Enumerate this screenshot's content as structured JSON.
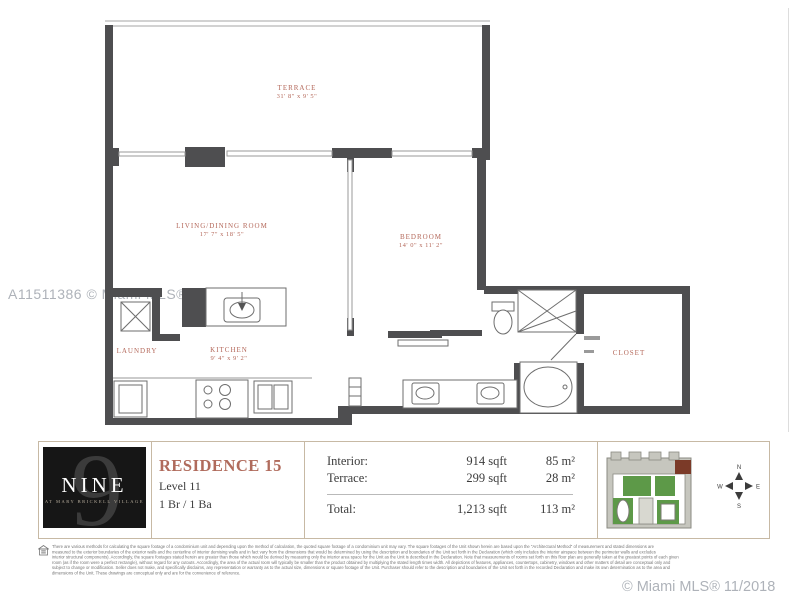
{
  "watermarks": {
    "left": "A11511386 © Miami MLS® 2023",
    "bottom_right": "© Miami MLS® 11/2018"
  },
  "colors": {
    "wall": "#4e4e50",
    "accent_terracotta": "#b06b5c",
    "info_border_tan": "#c7b9a4",
    "keyplan_green": "#5d9948",
    "keyplan_highlight": "#7b3a28"
  },
  "floorplan": {
    "rooms": {
      "terrace": {
        "name": "TERRACE",
        "dims": "31' 8\" x 9' 5\""
      },
      "living": {
        "name": "LIVING/DINING ROOM",
        "dims": "17' 7\" x 18' 5\""
      },
      "bedroom": {
        "name": "BEDROOM",
        "dims": "14' 0\" x 11' 2\""
      },
      "kitchen": {
        "name": "KITCHEN",
        "dims": "9' 4\" x 9' 2\""
      },
      "laundry": {
        "name": "LAUNDRY",
        "dims": ""
      },
      "closet": {
        "name": "CLOSET",
        "dims": ""
      }
    }
  },
  "info_bar": {
    "logo": {
      "number": "9",
      "name": "NINE",
      "tagline": "AT MARY BRICKELL VILLAGE"
    },
    "residence": {
      "title": "RESIDENCE 15",
      "level": "Level 11",
      "beds_baths": "1 Br / 1 Ba"
    },
    "areas": {
      "rows": [
        {
          "label": "Interior:",
          "sqft": "914 sqft",
          "metric": "85 m²"
        },
        {
          "label": "Terrace:",
          "sqft": "299 sqft",
          "metric": "28 m²"
        }
      ],
      "total": {
        "label": "Total:",
        "sqft": "1,213 sqft",
        "metric": "113 m²"
      }
    },
    "compass": {
      "n": "N",
      "e": "E",
      "s": "S",
      "w": "W"
    }
  },
  "disclaimer": {
    "lines": [
      "There are various methods for calculating the square footage of a condominium unit and depending upon the method of calculation, the quoted square footage of a condominium unit may vary. The square footages of the Unit shown herein are based upon the \"Architectural Method\" of measurement and stated dimensions are",
      "measured to the exterior boundaries of the exterior walls and the centerline of interior demising walls and in fact vary from the dimensions that would be determined by using the description and boundaries of the Unit set forth in the Declaration (which only includes the interior airspace between the perimeter walls and excludes",
      "interior structural components). Accordingly, the square footages stated herein are greater than those which would be derived by measuring only the interior area space for the Unit as the Unit is described in the Declaration. Note that measurements of rooms set forth on this floor plan are generally taken at the greatest points of each given",
      "room (as if the room were a perfect rectangle), without regard for any cutouts. Accordingly, the area of the actual room will typically be smaller than the product obtained by multiplying the stated length times width. All depictions of features, appliances, countertops, cabinetry, windows and other matters of detail are conceptual only and",
      "subject to change or modification. Seller does not make, and specifically disclaims, any representation or warranty as to the actual size, dimensions or square footage of the Unit. Purchaser should refer to the description and boundaries of the Unit set forth in the recorded Declaration and make its own determination as to the area and",
      "dimensions of the Unit. These drawings are conceptual only and are for the convenience of reference."
    ]
  }
}
